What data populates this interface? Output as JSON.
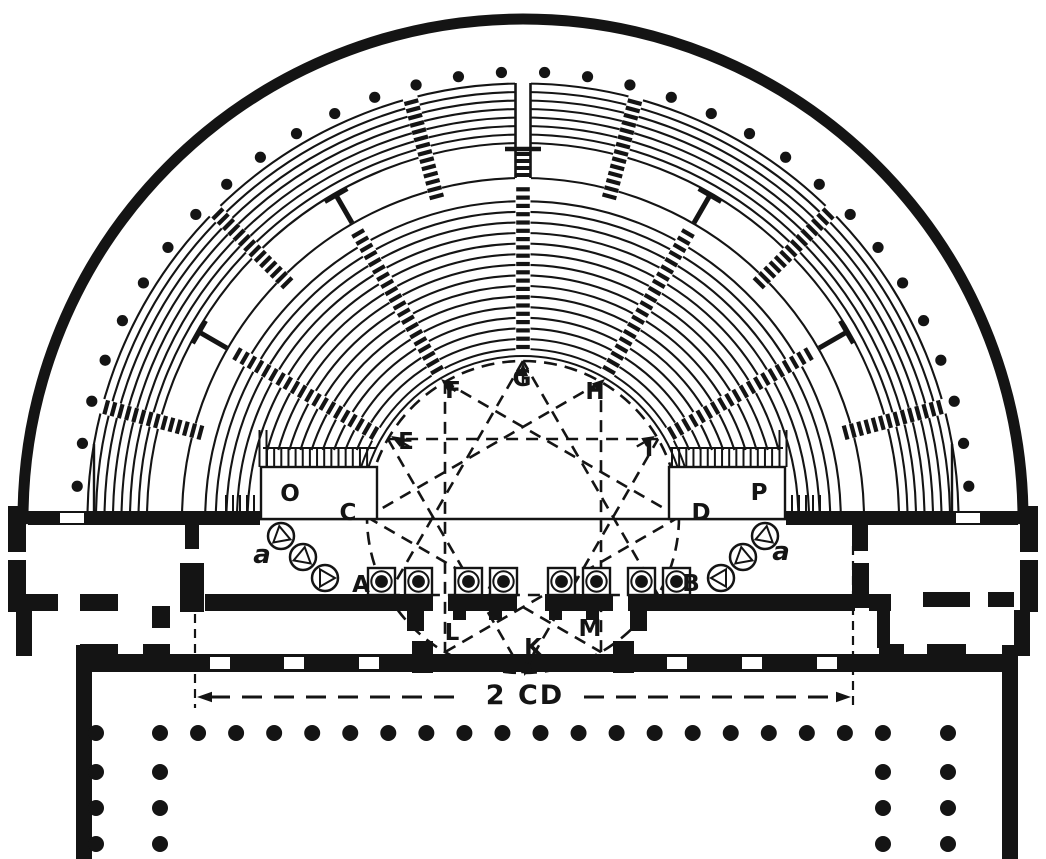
{
  "labels": {
    "A": "A",
    "B": "B",
    "C": "C",
    "D": "D",
    "E": "E",
    "F": "F",
    "G": "G",
    "H": "H",
    "I": "I",
    "K": "K",
    "L": "L",
    "M": "M",
    "O": "O",
    "P": "P",
    "a_left": "a",
    "a_right": "a"
  },
  "dimension": {
    "label": "2 CD"
  },
  "colors": {
    "ink": "#141414",
    "paper": "#ffffff"
  }
}
